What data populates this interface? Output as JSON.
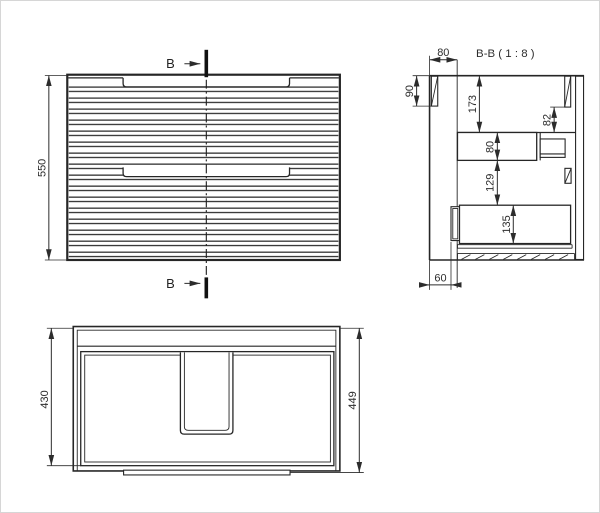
{
  "page": {
    "background": "#ffffff",
    "border_color": "#d6d6d6",
    "line_color": "#262626"
  },
  "front_view": {
    "section_label_top": "B",
    "section_label_bottom": "B",
    "dim_height": "550"
  },
  "section_view": {
    "title": "B-B ( 1 : 8 )",
    "dim_top_depth": "80",
    "dim_front_rail_height": "90",
    "dim_top_to_shelf": "173",
    "dim_back_offset": "82",
    "dim_shelf_height": "80",
    "dim_drawer_gap": "129",
    "dim_drawer_height": "135",
    "dim_bottom_depth": "60"
  },
  "plan_view": {
    "dim_inner_depth": "430",
    "dim_outer_depth": "449"
  }
}
